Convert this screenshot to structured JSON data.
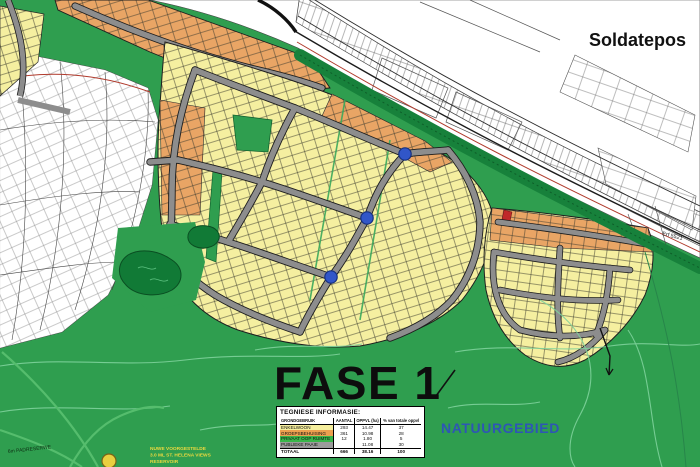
{
  "title": "Soldatepos",
  "labels": {
    "phase": "FASE 1",
    "nature": "NATUURGEBIED",
    "erf": "Erf 5521",
    "road_reserve": "6m PADRESERWE",
    "reservoir_line1": "NUWE VOORGESTELDE",
    "reservoir_line2": "3.0 ML ST. HELENA VIEWS",
    "reservoir_line3": "RESERVOIR"
  },
  "table": {
    "title": "TEGNIESE INFORMASIE:",
    "columns": [
      "GRONDGEBRUIK",
      "AANTAL",
      "OPPVL (ha)",
      "% van totale oppvl"
    ],
    "rows": [
      {
        "label": "ENKELWOON",
        "aantal": "293",
        "oppvl": "14.47",
        "persent": "37",
        "color": "#f6ef9d"
      },
      {
        "label": "GROEPSBEHUISING",
        "aantal": "361",
        "oppvl": "10.98",
        "persent": "28",
        "color": "#eda04f"
      },
      {
        "label": "PRIVAAT OOP RUIMTE",
        "aantal": "12",
        "oppvl": "1.80",
        "persent": "5",
        "color": "#39b54a"
      },
      {
        "label": "PUBLIEKE PAAIE",
        "aantal": "",
        "oppvl": "11.08",
        "persent": "30",
        "color": "#9b9b9b"
      }
    ],
    "total": {
      "label": "TOTAAL",
      "aantal": "666",
      "oppvl": "38.16",
      "persent": "100"
    }
  },
  "legend_colors": {
    "nature_green": "#2f9e4f",
    "tree_belt_green": "#17813b",
    "single_residential_yellow": "#f5efa0",
    "group_housing_orange": "#e9a565",
    "road_gray": "#8d8d8d",
    "traffic_circle_blue": "#3156c8",
    "nature_label_blue": "#2e4fbf",
    "boundary_red": "#b03a2c",
    "reservoir_yellow": "#e9cf3f"
  }
}
